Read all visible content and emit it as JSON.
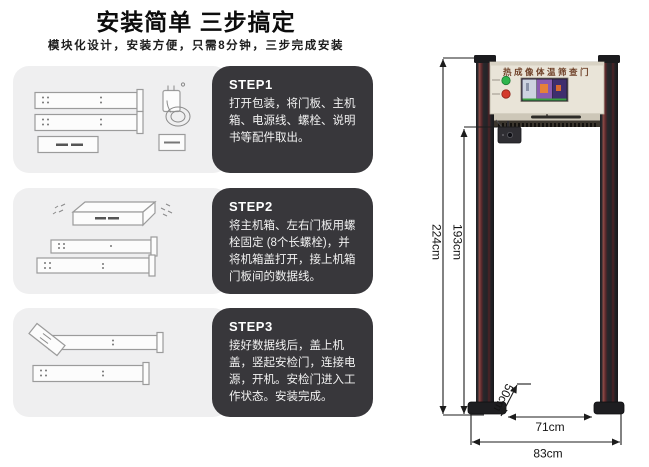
{
  "page": {
    "title": "安装简单 三步搞定",
    "subtitle": "模块化设计，安装方便，只需8分钟，三步完成安装"
  },
  "steps": [
    {
      "label": "STEP1",
      "text": "打开包装，将门板、主机箱、电源线、螺栓、说明书等配件取出。"
    },
    {
      "label": "STEP2",
      "text": "将主机箱、左右门板用螺栓固定 (8个长螺栓)，并将机箱盖打开，接上机箱门板间的数据线。"
    },
    {
      "label": "STEP3",
      "text": "接好数据线后，盖上机盖，竖起安检门，连接电源，开机。安检门进入工作状态。安装完成。"
    }
  ],
  "door": {
    "panel_title": "热成像体温筛查门",
    "dimensions": {
      "overall_height": "224cm",
      "inner_height": "193cm",
      "base_depth": "50cm",
      "inner_width": "71cm",
      "overall_width": "83cm"
    },
    "colors": {
      "led_green": "#2db54d",
      "led_red": "#d43a2c",
      "pillar_dark": "#232327",
      "pillar_maroon": "#5c262a",
      "header_beige": "#e9e4d8"
    }
  }
}
